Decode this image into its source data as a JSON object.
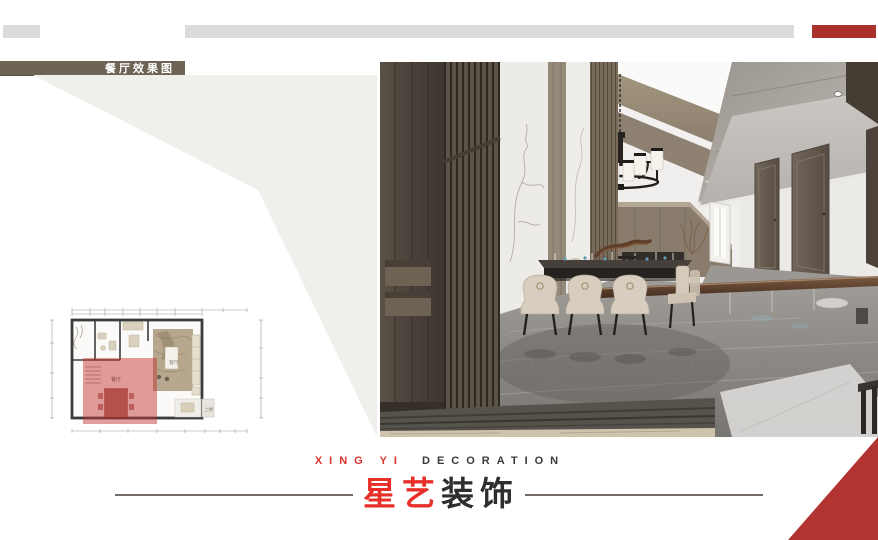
{
  "badge": {
    "label": "餐厅效果图"
  },
  "brand": {
    "en_red": "XING YI",
    "en_dark": "DECORATION",
    "zh_red": "星艺",
    "zh_dark": "装饰"
  },
  "floorplan": {
    "labels": {
      "dining": "餐厅",
      "living": "客厅",
      "stairs": "上楼"
    }
  },
  "colors": {
    "accent_red_bar": "#ab302c",
    "triangle_red": "#b23431",
    "logo_red": "#e8302a",
    "logo_dark": "#2f2d2d",
    "badge_olive": "#6e6455",
    "deco_bar_gray": "#dbdbdc",
    "wedge_gray": "#f0efec",
    "plan_highlight_red": "rgba(195,52,48,0.48)"
  }
}
